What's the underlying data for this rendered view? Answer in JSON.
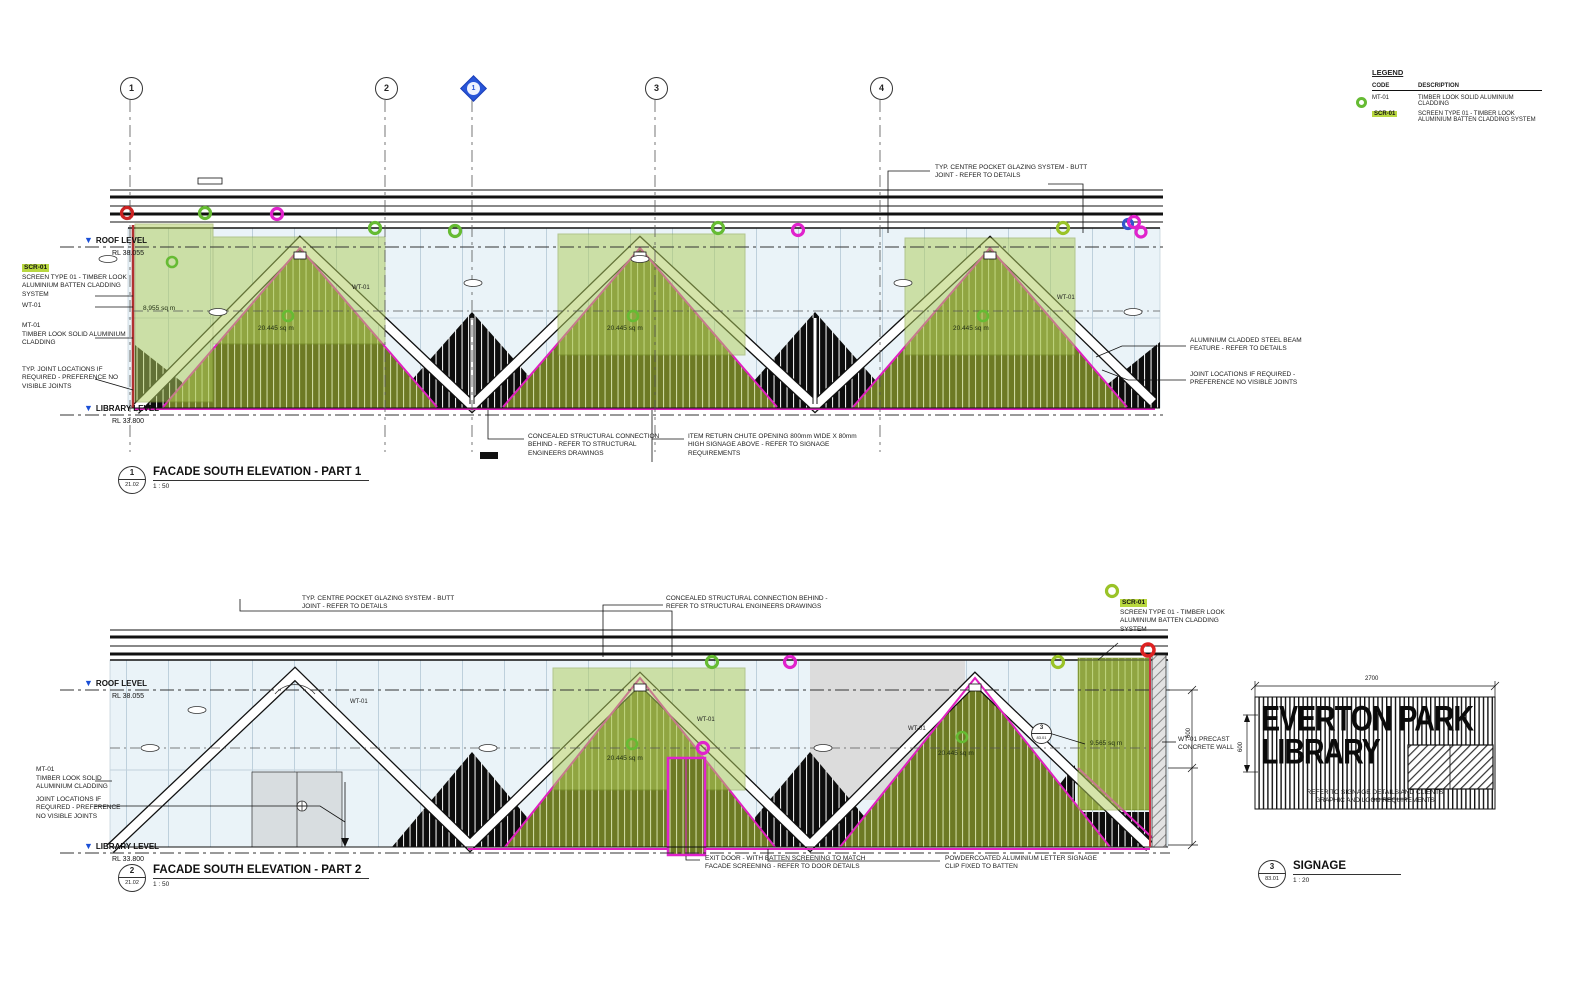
{
  "legend": {
    "title": "LEGEND",
    "code_header": "CODE",
    "description_header": "DESCRIPTION",
    "rows": [
      {
        "code": "MT-01",
        "description": "TIMBER LOOK SOLID ALUMINIUM CLADDING"
      },
      {
        "code": "SCR-01",
        "description": "SCREEN TYPE 01 - TIMBER LOOK ALUMINIUM BATTEN CLADDING SYSTEM"
      }
    ]
  },
  "grid": {
    "bubbles": [
      "1",
      "2",
      "1",
      "3",
      "4"
    ]
  },
  "levels": {
    "roof_label": "ROOF LEVEL",
    "roof_rl": "RL  38.055",
    "library_label": "LIBRARY LEVEL",
    "library_rl": "RL  33.800"
  },
  "part1": {
    "ref_number": "1",
    "ref_sheet": "21.02",
    "title": "FACADE SOUTH ELEVATION - PART 1",
    "scale": "1 : 50",
    "notes": {
      "glazing": "TYP. CENTRE POCKET GLAZING SYSTEM - BUTT JOINT - REFER TO DETAILS",
      "scr_code": "SCR-01",
      "scr_text": "SCREEN TYPE 01 - TIMBER LOOK ALUMINIUM BATTEN CLADDING SYSTEM",
      "wt_code": "WT-01",
      "mt_code": "MT-01",
      "mt_text": "TIMBER LOOK SOLID ALUMINIUM CLADDING",
      "joints_left": "TYP. JOINT LOCATIONS IF REQUIRED - PREFERENCE NO VISIBLE JOINTS",
      "beam": "ALUMINIUM CLADDED STEEL BEAM FEATURE - REFER TO DETAILS",
      "joints_right": "JOINT LOCATIONS IF REQUIRED - PREFERENCE NO VISIBLE JOINTS",
      "concealed": "CONCEALED STRUCTURAL CONNECTION BEHIND - REFER TO STRUCTURAL ENGINEERS DRAWINGS",
      "chute": "ITEM RETURN CHUTE OPENING 800mm WIDE X 80mm HIGH SIGNAGE ABOVE - REFER TO SIGNAGE REQUIREMENTS"
    },
    "areas": [
      "8.955 sq m",
      "20.445 sq m",
      "20.445 sq m",
      "20.445 sq m"
    ],
    "wt_labels": [
      "WT-01",
      "WT-01"
    ]
  },
  "part2": {
    "ref_number": "2",
    "ref_sheet": "21.02",
    "title": "FACADE SOUTH ELEVATION - PART 2",
    "scale": "1 : 50",
    "notes": {
      "glazing": "TYP. CENTRE POCKET GLAZING SYSTEM - BUTT JOINT - REFER TO DETAILS",
      "concealed": "CONCEALED STRUCTURAL CONNECTION BEHIND - REFER TO STRUCTURAL ENGINEERS DRAWINGS",
      "scr_code": "SCR-01",
      "scr_text": "SCREEN TYPE 01 - TIMBER LOOK ALUMINIUM BATTEN CLADDING SYSTEM",
      "mt_code": "MT-01",
      "mt_text": "TIMBER LOOK SOLID ALUMINIUM CLADDING",
      "joints_left": "JOINT LOCATIONS IF REQUIRED - PREFERENCE NO VISIBLE JOINTS",
      "exit_door": "EXIT DOOR - WITH BATTEN SCREENING TO MATCH FACADE SCREENING - REFER TO DOOR DETAILS",
      "letter_signage": "POWDERCOATED ALUMINIUM LETTER SIGNAGE CLIP FIXED TO BATTEN",
      "precast": "WT-01 PRECAST CONCRETE WALL"
    },
    "areas": [
      "20.445 sq m",
      "20.445 sq m",
      "9.565 sq m"
    ],
    "wt_labels": [
      "WT-01",
      "WT-01",
      "WT-01"
    ],
    "callout_number": "3",
    "callout_sheet": "83.01",
    "dim_600": "600"
  },
  "signage": {
    "ref_number": "3",
    "ref_sheet": "83.01",
    "title": "SIGNAGE",
    "scale": "1 : 20",
    "line1": "EVERTON PARK",
    "line2": "LIBRARY",
    "dim_width": "2700",
    "dim_height": "600",
    "note": "REFER TO SIGNAGE DETAILS AND CLIENTS GRAPHIC AND LOGO REQUIREMENTS"
  }
}
